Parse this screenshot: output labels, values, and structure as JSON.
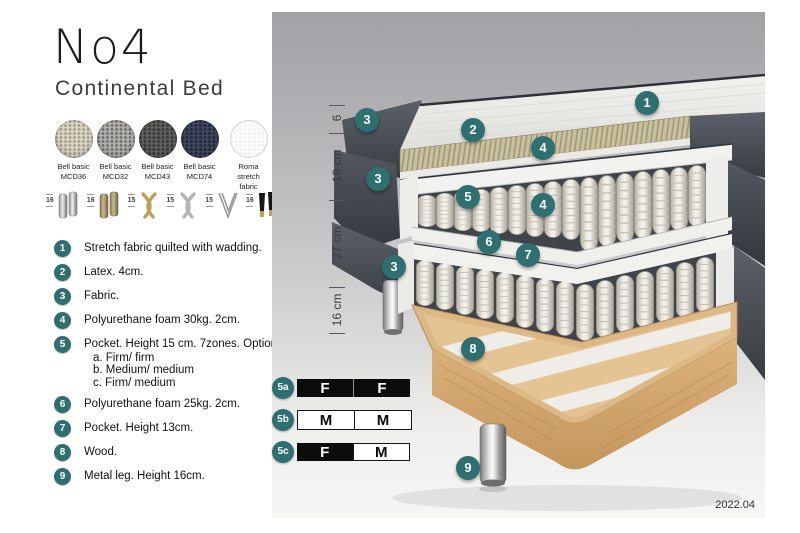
{
  "header": {
    "title": "No4",
    "subtitle": "Continental Bed"
  },
  "fabrics": [
    {
      "line1": "Bell basic",
      "line2": "MCD36",
      "base": "#d9d4c6",
      "dot": "#a29b89"
    },
    {
      "line1": "Bell basic",
      "line2": "MCD32",
      "base": "#b2b0ac",
      "dot": "#6f6d69"
    },
    {
      "line1": "Bell basic",
      "line2": "MCD43",
      "base": "#5f5f5d",
      "dot": "#373735"
    },
    {
      "line1": "Bell basic",
      "line2": "MCD74",
      "base": "#40465f",
      "dot": "#222736"
    },
    {
      "line1": "Roma",
      "line2": "stretch fabric",
      "base": "#fcfcfc",
      "dot": "#f1f1f0"
    }
  ],
  "legs": [
    {
      "height": "16",
      "name": "chrome cylinder legs"
    },
    {
      "height": "16",
      "name": "brass cylinder legs"
    },
    {
      "height": "15",
      "name": "gold cross legs"
    },
    {
      "height": "15",
      "name": "silver cross legs"
    },
    {
      "height": "15",
      "name": "hairpin leg"
    },
    {
      "height": "16",
      "name": "black tapered legs with brass foot"
    }
  ],
  "parts": [
    {
      "num": "1",
      "text": "Stretch fabric quilted with wadding."
    },
    {
      "num": "2",
      "text": "Latex. 4cm."
    },
    {
      "num": "3",
      "text": "Fabric."
    },
    {
      "num": "4",
      "text": "Polyurethane foam 30kg. 2cm."
    },
    {
      "num": "5",
      "text": "Pocket. Height 15 cm. 7zones. Option:",
      "options": [
        "a. Firm/ firm",
        "b. Medium/ medium",
        "c. Firm/ medium"
      ]
    },
    {
      "num": "6",
      "text": "Polyurethane foam 25kg. 2cm."
    },
    {
      "num": "7",
      "text": "Pocket. Height 13cm."
    },
    {
      "num": "8",
      "text": "Wood."
    },
    {
      "num": "9",
      "text": "Metal leg. Height 16cm."
    }
  ],
  "diagram": {
    "measurements": [
      "6",
      "19 cm",
      "27 cm",
      "16 cm"
    ],
    "callouts": {
      "c1": "1",
      "c2": "2",
      "c3a": "3",
      "c3b": "3",
      "c3c": "3",
      "c4a": "4",
      "c4b": "4",
      "c5": "5",
      "c6": "6",
      "c7": "7",
      "c8": "8",
      "c9": "9"
    },
    "firmness": [
      {
        "id": "5a",
        "cells": [
          {
            "label": "F",
            "filled": true
          },
          {
            "label": "F",
            "filled": true
          }
        ]
      },
      {
        "id": "5b",
        "cells": [
          {
            "label": "M",
            "filled": false
          },
          {
            "label": "M",
            "filled": false
          }
        ]
      },
      {
        "id": "5c",
        "cells": [
          {
            "label": "F",
            "filled": true
          },
          {
            "label": "M",
            "filled": false
          }
        ]
      }
    ],
    "version": "2022.04",
    "colors": {
      "accent": "#2e6f6f",
      "upholstery": "#4a4f57",
      "latex": "#c8c19e",
      "spring": "#e8e5dd",
      "wood": "#e3c28f"
    }
  }
}
